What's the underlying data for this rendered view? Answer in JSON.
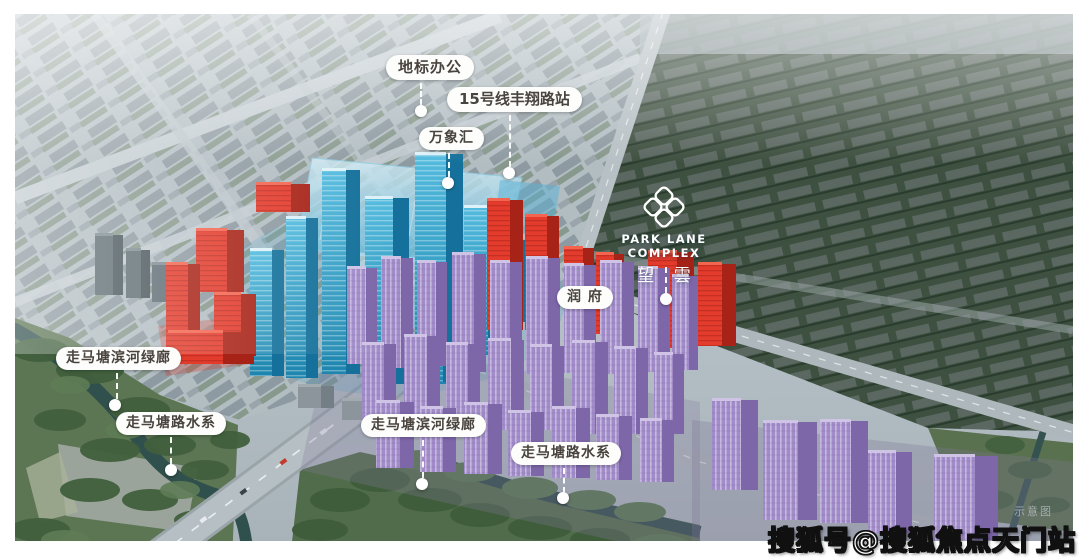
{
  "logo": {
    "brand": "PARK LANE COMPLEX",
    "name_cn": "望 雲"
  },
  "callouts": [
    {
      "id": "landmark-office",
      "label": "地标办公"
    },
    {
      "id": "line15-fengxiang-station",
      "label": "15号线丰翔路站"
    },
    {
      "id": "wanxianghui-mall",
      "label": "万象汇"
    },
    {
      "id": "runfu",
      "label": "润 府"
    },
    {
      "id": "green-corridor-left",
      "label": "走马塘滨河绿廊"
    },
    {
      "id": "waterway-left",
      "label": "走马塘路水系"
    },
    {
      "id": "green-corridor-center",
      "label": "走马塘滨河绿廊"
    },
    {
      "id": "waterway-center",
      "label": "走马塘路水系"
    }
  ],
  "watermark": {
    "text": "搜狐号@搜狐焦点天门站",
    "note": "示意图"
  },
  "palette": {
    "highlight_blue": "#2d9ec6",
    "highlight_red": "#e33b2c",
    "highlight_purple": "#a18cc9",
    "label_bg": "#fdfdfb",
    "label_text": "#4a443f",
    "water": "#30504d",
    "park_green": "#5c7553"
  },
  "scene": {
    "clusters": [
      {
        "id": "gray-towers",
        "face": "#5f6d74",
        "side": "#49565c",
        "roof": "#7e8c92",
        "stripe": "",
        "towers": [
          [
            95,
            233,
            28,
            62
          ],
          [
            126,
            248,
            24,
            50
          ],
          [
            152,
            262,
            22,
            40
          ]
        ]
      },
      {
        "id": "gray-low-blocks",
        "face": "#8b959b",
        "side": "#747f85",
        "roof": "#a2abb0",
        "stripe": "",
        "towers": [
          [
            298,
            384,
            36,
            24
          ],
          [
            342,
            398,
            42,
            22
          ]
        ]
      },
      {
        "id": "blue-commercial",
        "face": "url(#gFaceB)",
        "side": "#15719b",
        "roof": "#def1f8",
        "stripe": "stripeB",
        "towers": [
          [
            250,
            248,
            34,
            128
          ],
          [
            286,
            216,
            32,
            162
          ],
          [
            322,
            168,
            38,
            206
          ],
          [
            365,
            196,
            44,
            188
          ],
          [
            415,
            152,
            48,
            232
          ],
          [
            464,
            205,
            38,
            150
          ],
          [
            424,
            304,
            30,
            78
          ],
          [
            500,
            238,
            26,
            84
          ]
        ]
      },
      {
        "id": "red-residential",
        "face": "#e33b2c",
        "side": "#a82317",
        "roof": "#f3654f",
        "stripe": "stripeR",
        "towers": [
          [
            256,
            182,
            54,
            30
          ],
          [
            196,
            228,
            48,
            64
          ],
          [
            166,
            262,
            34,
            94
          ],
          [
            214,
            292,
            42,
            64
          ],
          [
            168,
            330,
            86,
            34
          ],
          [
            487,
            198,
            36,
            132
          ],
          [
            525,
            214,
            34,
            116
          ],
          [
            564,
            246,
            30,
            88
          ],
          [
            596,
            252,
            28,
            82
          ],
          [
            648,
            250,
            46,
            98
          ],
          [
            698,
            262,
            38,
            84
          ]
        ]
      },
      {
        "id": "purple-main",
        "face": "#a18cc9",
        "side": "#7d67a9",
        "roof": "#d0c4e6",
        "stripe": "stripeP",
        "towers": [
          [
            347,
            266,
            30,
            98
          ],
          [
            381,
            256,
            32,
            112
          ],
          [
            417,
            260,
            30,
            106
          ],
          [
            452,
            252,
            34,
            120
          ],
          [
            490,
            260,
            32,
            110
          ],
          [
            526,
            256,
            34,
            118
          ],
          [
            564,
            263,
            32,
            110
          ],
          [
            600,
            260,
            34,
            114
          ],
          [
            638,
            266,
            32,
            106
          ],
          [
            672,
            274,
            26,
            96
          ],
          [
            362,
            342,
            34,
            80
          ],
          [
            404,
            334,
            36,
            92
          ],
          [
            446,
            342,
            34,
            86
          ],
          [
            488,
            338,
            36,
            92
          ],
          [
            530,
            344,
            34,
            86
          ],
          [
            572,
            340,
            36,
            94
          ],
          [
            614,
            346,
            34,
            88
          ],
          [
            654,
            352,
            30,
            82
          ],
          [
            376,
            400,
            38,
            68
          ],
          [
            420,
            406,
            36,
            66
          ],
          [
            464,
            402,
            38,
            72
          ],
          [
            508,
            410,
            36,
            66
          ],
          [
            552,
            406,
            38,
            72
          ],
          [
            596,
            414,
            36,
            66
          ],
          [
            640,
            418,
            34,
            64
          ]
        ]
      },
      {
        "id": "purple-right",
        "face": "#a18cc9",
        "side": "#7d67a9",
        "roof": "#d0c4e6",
        "stripe": "stripeP",
        "towers": [
          [
            712,
            398,
            46,
            92
          ],
          [
            763,
            420,
            54,
            100
          ],
          [
            820,
            419,
            48,
            104
          ],
          [
            868,
            450,
            44,
            83
          ],
          [
            934,
            454,
            64,
            86
          ]
        ]
      }
    ]
  }
}
